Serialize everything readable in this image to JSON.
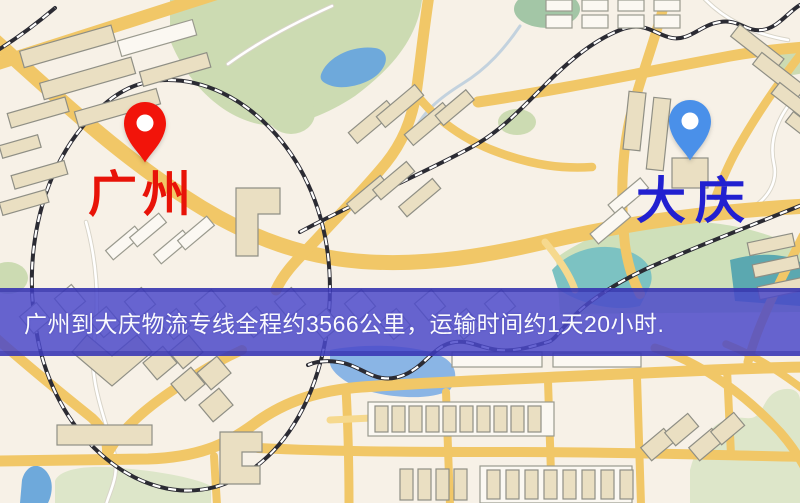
{
  "palette": {
    "origin-color": "#e81308",
    "destination-color": "#2220d0",
    "origin-pin": "#f2140a",
    "destination-pin": "#4a90e9",
    "pin-hole": "#ffffff",
    "banner-bg": "#4a48c9d6",
    "banner-text": "#ffffff"
  },
  "map": {
    "origin": {
      "name": "广州"
    },
    "destination": {
      "name": "大庆"
    }
  },
  "banner": {
    "text": "广州到大庆物流专线全程约3566公里，运输时间约1天20小时."
  }
}
